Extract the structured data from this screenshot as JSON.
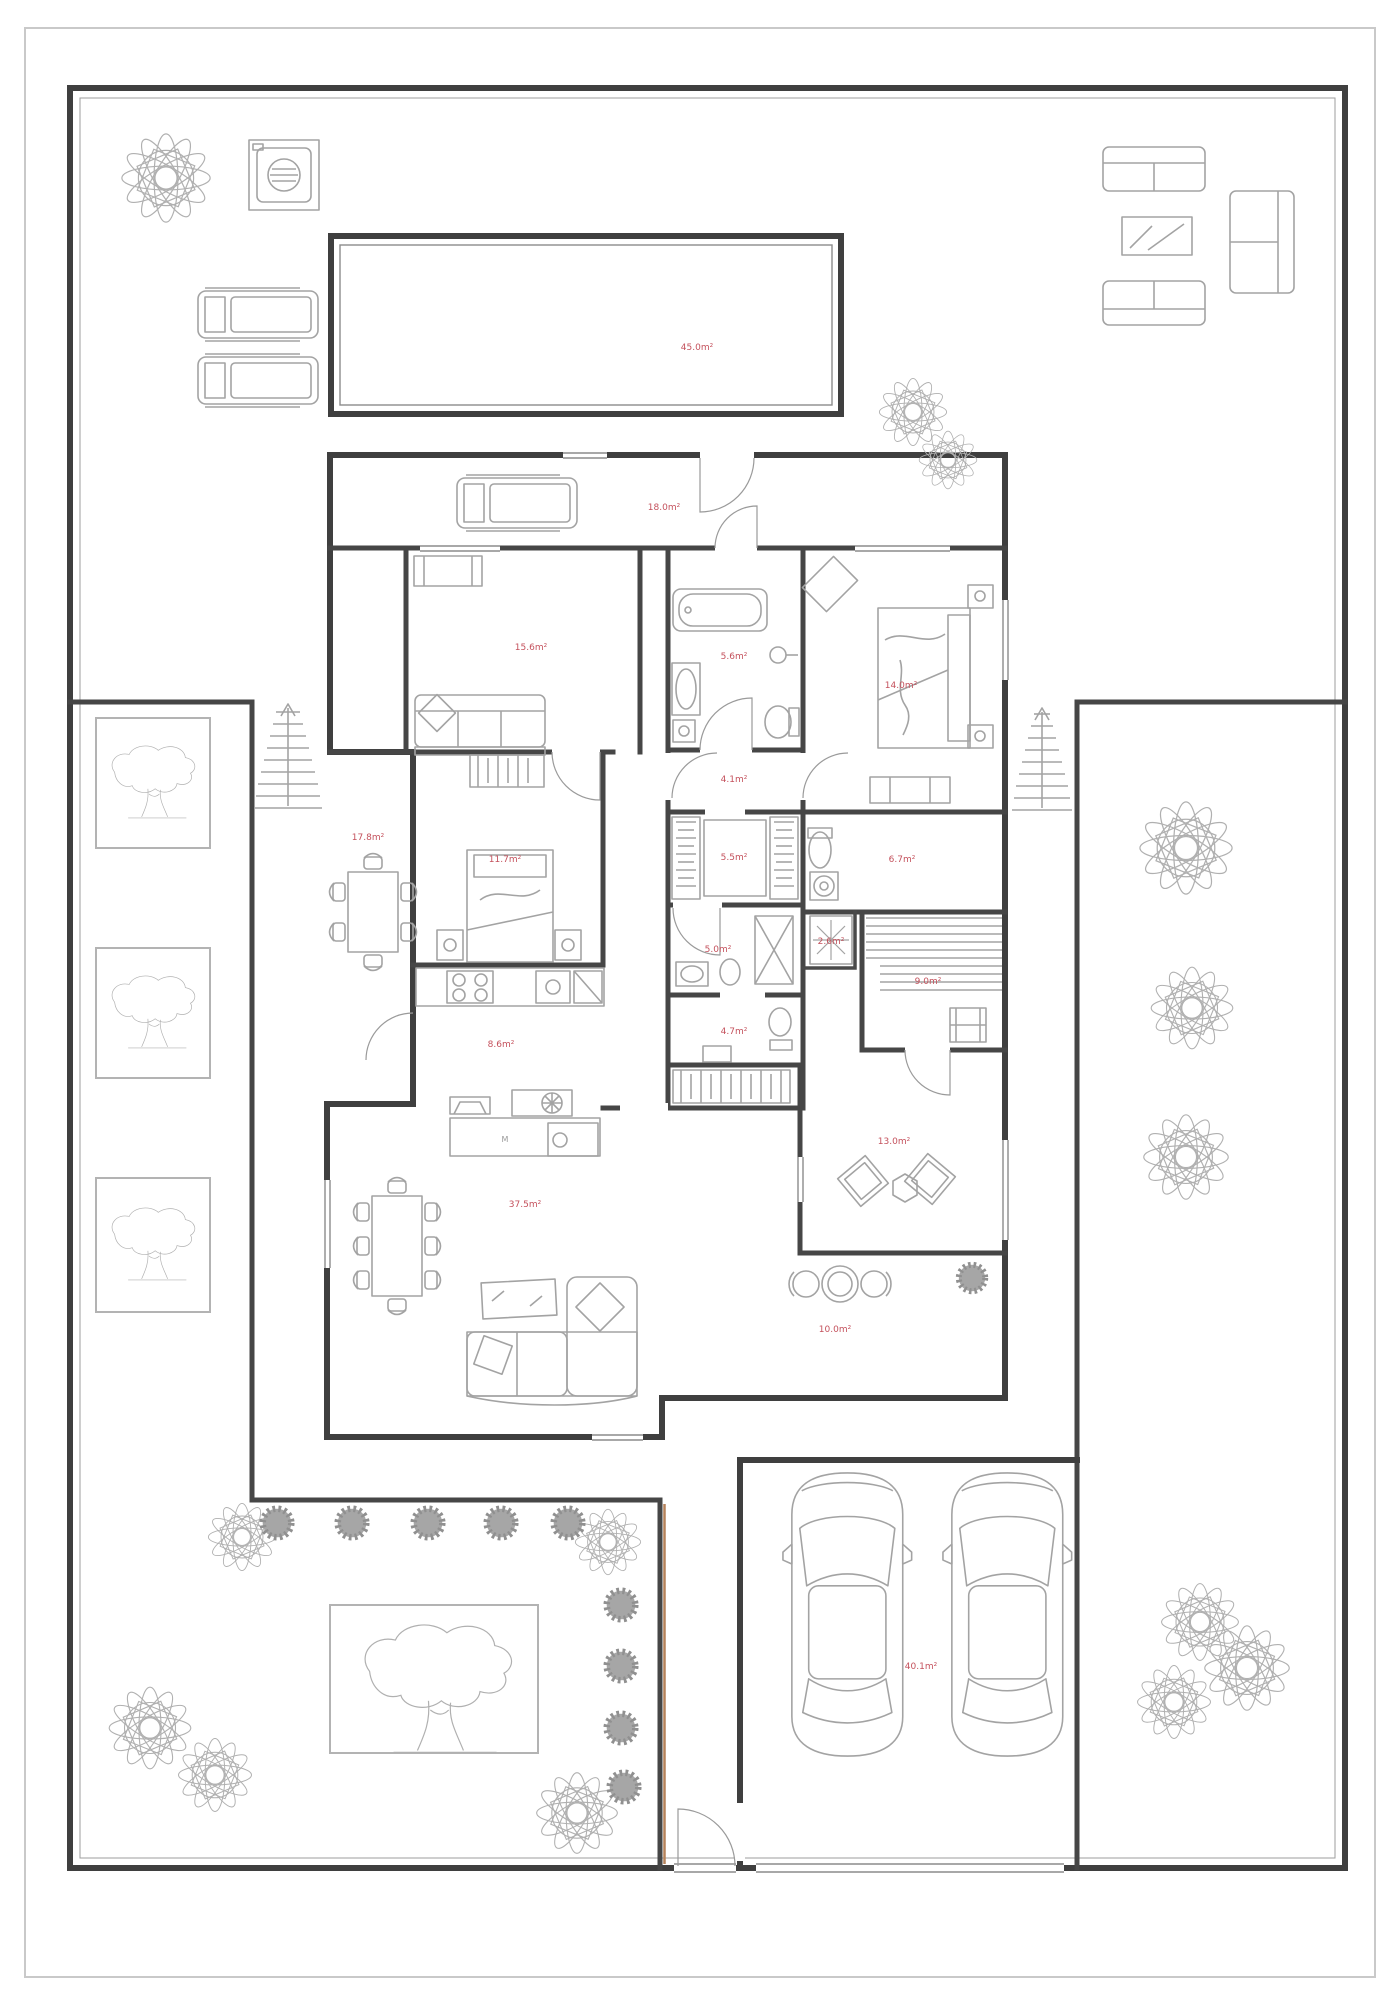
{
  "title": "house-floor-plan",
  "colors": {
    "wall": "#3f3f3f",
    "furniture": "#a3a3a3",
    "area_label": "#c4515c",
    "wood_accent": "#b5825a",
    "page_frame": "#c9c9c9"
  },
  "kitchen_island_label": "M",
  "rooms": [
    {
      "id": "pool",
      "area": "45.0m²"
    },
    {
      "id": "entry-hall",
      "area": "18.0m²"
    },
    {
      "id": "living-upper",
      "area": "15.6m²"
    },
    {
      "id": "bathroom",
      "area": "5.6m²"
    },
    {
      "id": "bedroom-right",
      "area": "14.0m²"
    },
    {
      "id": "corridor",
      "area": "4.1m²"
    },
    {
      "id": "walk-in-closet",
      "area": "5.5m²"
    },
    {
      "id": "utility-wc",
      "area": "6.7m²"
    },
    {
      "id": "dining-terrace",
      "area": "17.8m²"
    },
    {
      "id": "bedroom-left",
      "area": "11.7m²"
    },
    {
      "id": "shower-room",
      "area": "5.0m²"
    },
    {
      "id": "steam-shower",
      "area": "2.6m²"
    },
    {
      "id": "sauna",
      "area": "9.0m²"
    },
    {
      "id": "kitchen",
      "area": "8.6m²"
    },
    {
      "id": "hallway",
      "area": "4.7m²"
    },
    {
      "id": "lounge",
      "area": "13.0m²"
    },
    {
      "id": "living-room",
      "area": "37.5m²"
    },
    {
      "id": "terrace",
      "area": "10.0m²"
    },
    {
      "id": "garage",
      "area": "40.1m²"
    }
  ]
}
